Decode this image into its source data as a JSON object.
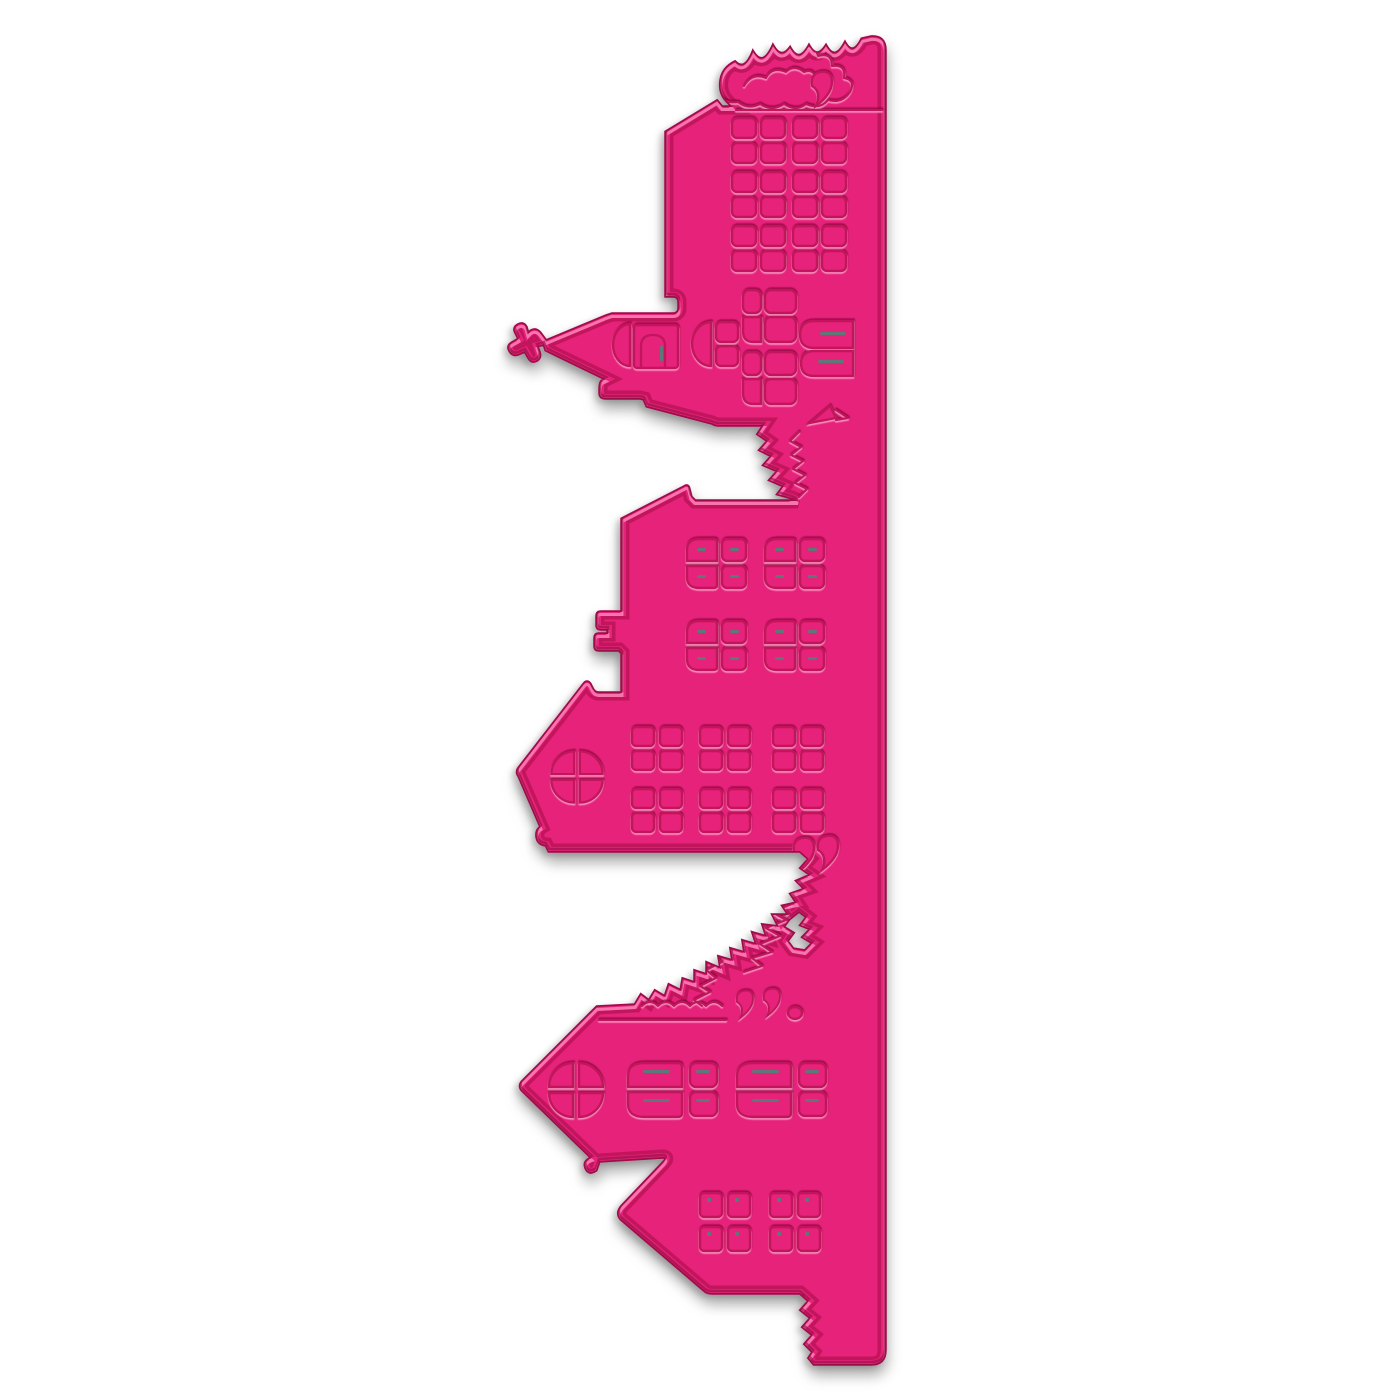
{
  "image": {
    "description": "Bright pink metal craft cutting die of a Christmas village skyline border, photographed vertically on a white background. From top to bottom: a tall apartment building with tree canopy on its roof, a church with pointed steeple and cross finial, a town house with a chimney, a gabled house with a round quatrefoil window, two pine trees, and a large house with porch gable and scalloped bush edge at the bottom.",
    "alt": "Pink village border cutting die product photo",
    "type": "product-photo",
    "background": "white"
  },
  "die": {
    "label": "christmas-village-edge-die",
    "orientation": "vertical",
    "material_look": "embossed metal",
    "components": [
      {
        "name": "tree-canopy-top",
        "detail": "scalloped foliage along top edge with comma swirl"
      },
      {
        "name": "apartment-building",
        "small_windows": 24
      },
      {
        "name": "church",
        "pane_windows": 12,
        "wide_windows": 2,
        "steeple": "pointed spire with cross finial, arched window and door"
      },
      {
        "name": "pennant-roof-detail",
        "detail": "small embossed roof peak beside ledge"
      },
      {
        "name": "pine-tree-small",
        "detail": "between church and town house"
      },
      {
        "name": "town-house",
        "pane_windows": 16,
        "chimney_tabs": 2
      },
      {
        "name": "gable-house",
        "small_windows": 24,
        "quatrefoil_window": 1
      },
      {
        "name": "pine-trees-large",
        "count": 2,
        "cutout_hole": 1,
        "comma_swirls": 2
      },
      {
        "name": "porch-house",
        "large_panes": 8,
        "quatrefoil_window": 1,
        "porch_windows": 8,
        "comma_swirls": 3
      },
      {
        "name": "bush-scallop-edge-bottom",
        "detail": "wavy cut edge at lower right"
      }
    ]
  },
  "colors": {
    "background": "#ffffff",
    "pink": "#e6217a",
    "pinkLight": "#f0418f",
    "pinkDark": "#d91868",
    "edge": "#9d0b47",
    "groove": "#c2135c",
    "highlight": "#ff8fc1",
    "innerShade": "#8e0a40",
    "slit": "#4e8277",
    "shadow": "rgba(0,0,0,0.35)"
  }
}
